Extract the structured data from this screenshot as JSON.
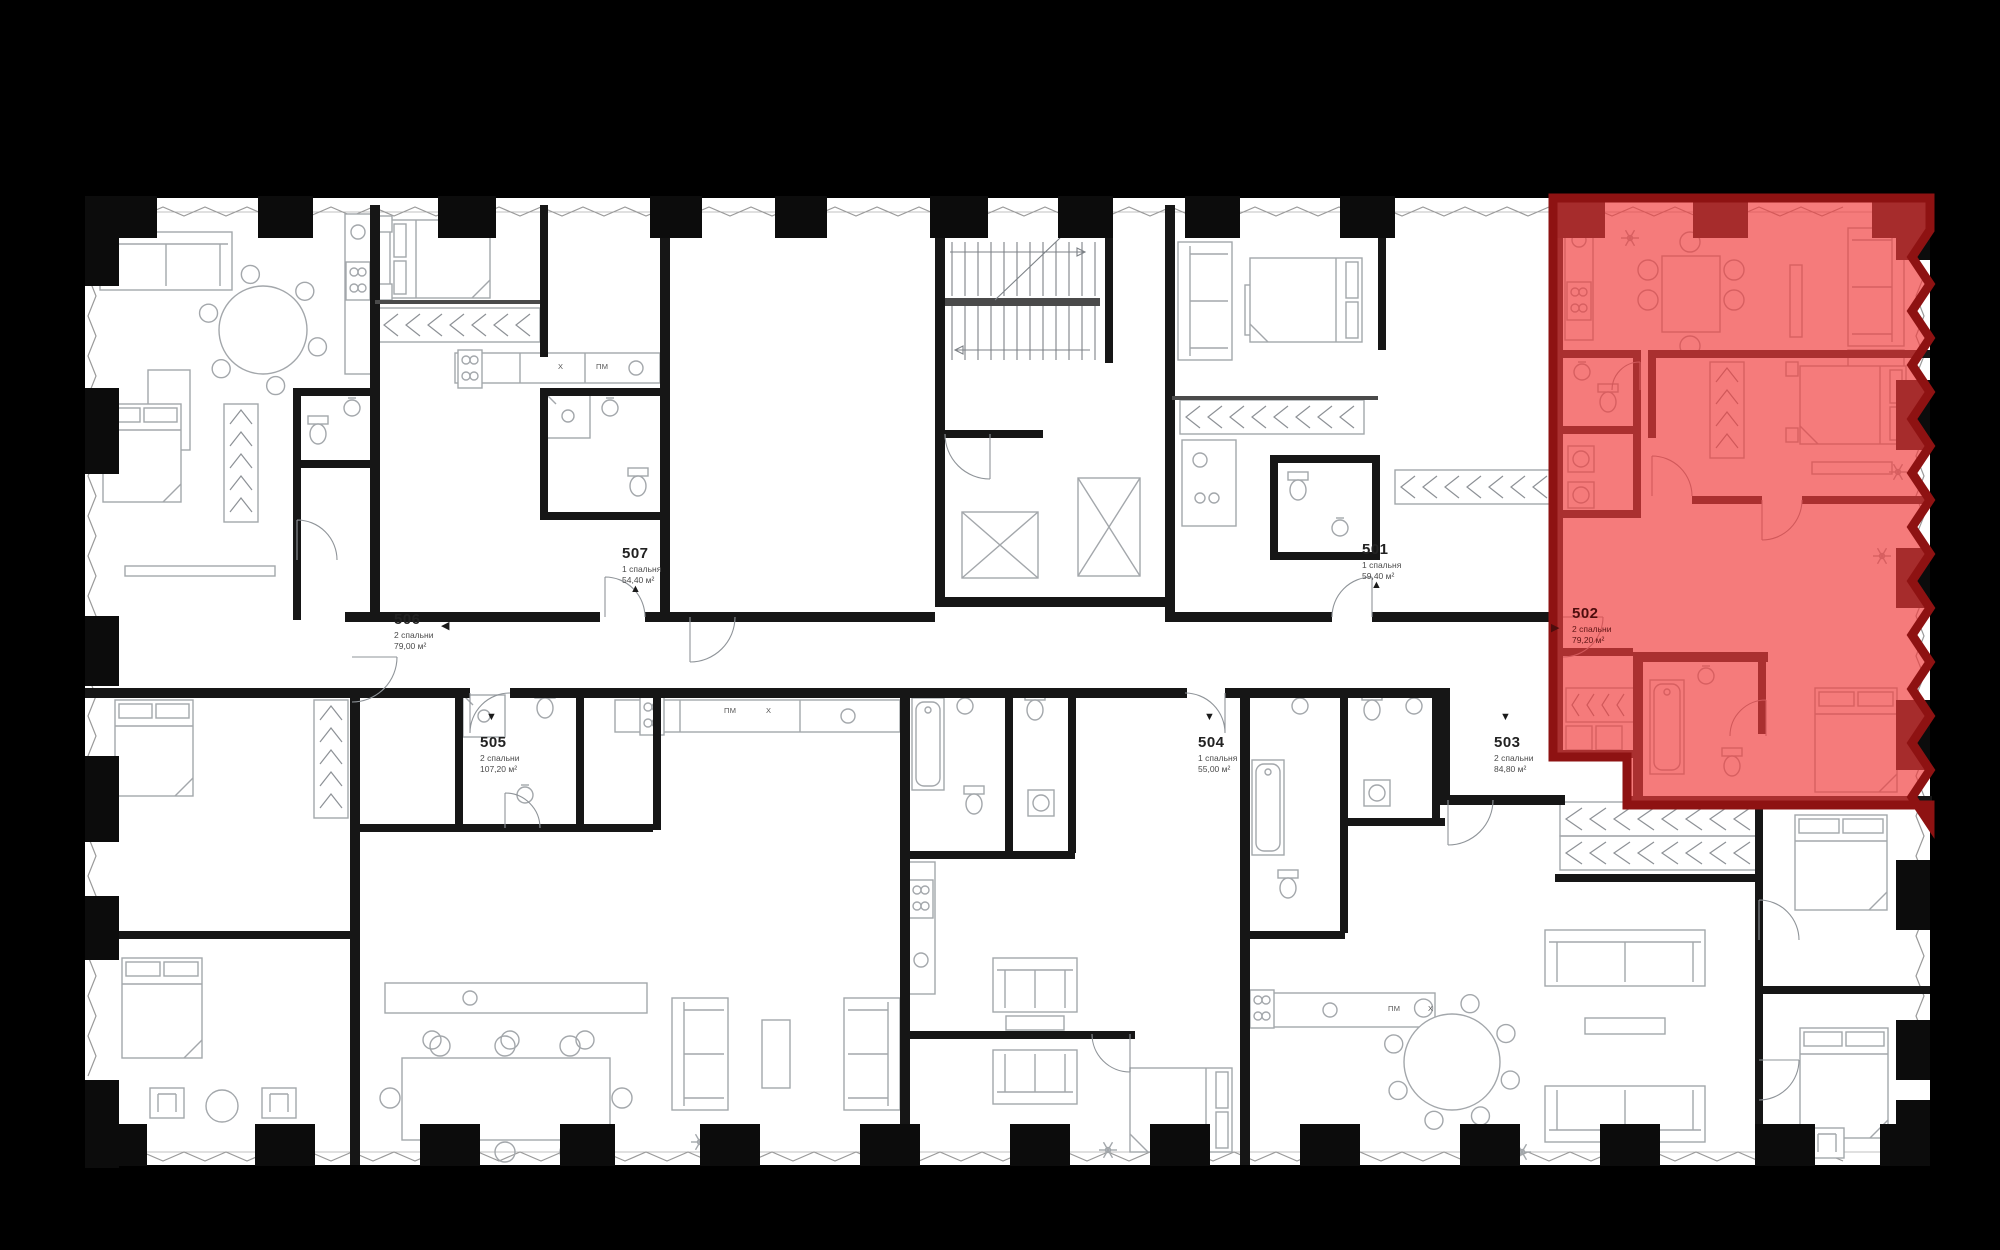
{
  "colors": {
    "background": "#000000",
    "floor": "#ffffff",
    "walls": "#161616",
    "furniture": "#a3a7ab",
    "highlight_fill": "rgba(240,60,60,0.68)",
    "highlight_wall": "#8e1212",
    "label_text": "#222222",
    "label_sub_text": "#4a4a4a",
    "highlight_label_text": "#4d0d0d"
  },
  "apartments": [
    {
      "id": "501",
      "bedrooms": "1 спальня",
      "area": "59,40 м²",
      "highlighted": false,
      "label_x": 1362,
      "label_y": 540,
      "marker": "▲",
      "marker_x": 1371,
      "marker_y": 579
    },
    {
      "id": "502",
      "bedrooms": "2 спальни",
      "area": "79,20 м²",
      "highlighted": true,
      "label_x": 1572,
      "label_y": 604,
      "marker": "▶",
      "marker_x": 1551,
      "marker_y": 621
    },
    {
      "id": "503",
      "bedrooms": "2 спальни",
      "area": "84,80 м²",
      "highlighted": false,
      "label_x": 1494,
      "label_y": 733,
      "marker": "▼",
      "marker_x": 1500,
      "marker_y": 711
    },
    {
      "id": "504",
      "bedrooms": "1 спальня",
      "area": "55,00 м²",
      "highlighted": false,
      "label_x": 1198,
      "label_y": 733,
      "marker": "▼",
      "marker_x": 1204,
      "marker_y": 711
    },
    {
      "id": "505",
      "bedrooms": "2 спальни",
      "area": "107,20 м²",
      "highlighted": false,
      "label_x": 480,
      "label_y": 733,
      "marker": "▼",
      "marker_x": 486,
      "marker_y": 711
    },
    {
      "id": "506",
      "bedrooms": "2 спальни",
      "area": "79,00 м²",
      "highlighted": false,
      "label_x": 394,
      "label_y": 610,
      "marker": "◀",
      "marker_x": 441,
      "marker_y": 619
    },
    {
      "id": "507",
      "bedrooms": "1 спальня",
      "area": "54,40 м²",
      "highlighted": false,
      "label_x": 622,
      "label_y": 544,
      "marker": "▲",
      "marker_x": 630,
      "marker_y": 583
    }
  ],
  "appliance_tags": [
    {
      "label": "Х",
      "x": 558,
      "y": 362
    },
    {
      "label": "ПМ",
      "x": 596,
      "y": 362
    },
    {
      "label": "ПМ",
      "x": 724,
      "y": 706
    },
    {
      "label": "Х",
      "x": 766,
      "y": 706
    },
    {
      "label": "ПМ",
      "x": 1388,
      "y": 1004
    },
    {
      "label": "Х",
      "x": 1428,
      "y": 1004
    }
  ]
}
